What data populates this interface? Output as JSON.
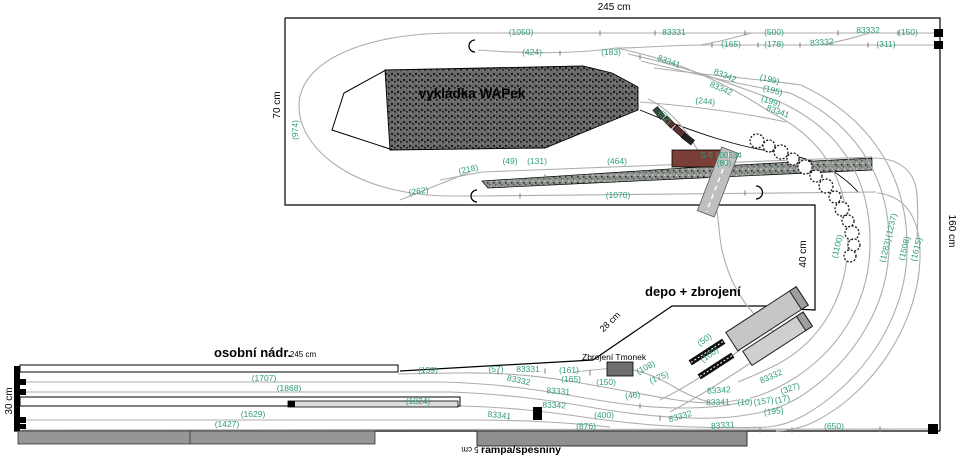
{
  "plan": {
    "areas": {
      "unloading_title": "vykládka WAPek",
      "depot_title": "depo + zbrojení",
      "station_title": "osobní nádr.",
      "ramp_label": "rampa/spesniny",
      "armory_label": "Zbrojení Tmonek"
    },
    "bridge": {
      "id": "S-5 100534",
      "length": "(80)"
    },
    "dim_labels": [
      {
        "t": "245 cm",
        "x": 614,
        "y": 10,
        "r": 0,
        "s": 10
      },
      {
        "t": "160 cm",
        "x": 949,
        "y": 231,
        "r": 90,
        "s": 10
      },
      {
        "t": "70 cm",
        "x": 280,
        "y": 105,
        "r": -90,
        "s": 10
      },
      {
        "t": "40 cm",
        "x": 806,
        "y": 254,
        "r": -90,
        "s": 10
      },
      {
        "t": "28 cm",
        "x": 612,
        "y": 324,
        "r": -44,
        "s": 9
      },
      {
        "t": "30 cm",
        "x": 12,
        "y": 401,
        "r": -90,
        "s": 10
      },
      {
        "t": "245 cm",
        "x": 303,
        "y": 357,
        "r": 0,
        "s": 8
      },
      {
        "t": "5 cm",
        "x": 470,
        "y": 447,
        "r": 180,
        "s": 8
      }
    ],
    "track_labels": [
      {
        "t": "(1050)",
        "x": 521,
        "y": 35,
        "r": 0
      },
      {
        "t": "83331",
        "x": 674,
        "y": 35,
        "r": 0
      },
      {
        "t": "(500)",
        "x": 774,
        "y": 35,
        "r": 0
      },
      {
        "t": "83332",
        "x": 868,
        "y": 33,
        "r": 0
      },
      {
        "t": "(150)",
        "x": 908,
        "y": 35,
        "r": 0
      },
      {
        "t": "(165)",
        "x": 731,
        "y": 47,
        "r": 0
      },
      {
        "t": "(178)",
        "x": 774,
        "y": 47,
        "r": 0
      },
      {
        "t": "83332",
        "x": 822,
        "y": 45,
        "r": -4
      },
      {
        "t": "(311)",
        "x": 886,
        "y": 47,
        "r": 0
      },
      {
        "t": "(424)",
        "x": 532,
        "y": 55,
        "r": 0
      },
      {
        "t": "(183)",
        "x": 611,
        "y": 55,
        "r": 0
      },
      {
        "t": "(974)",
        "x": 298,
        "y": 130,
        "r": -90
      },
      {
        "t": "83341",
        "x": 668,
        "y": 64,
        "r": 20
      },
      {
        "t": "83342",
        "x": 724,
        "y": 78,
        "r": 22
      },
      {
        "t": "83342",
        "x": 720,
        "y": 91,
        "r": 24
      },
      {
        "t": "(199)",
        "x": 769,
        "y": 82,
        "r": 14
      },
      {
        "t": "(195)",
        "x": 772,
        "y": 93,
        "r": 16
      },
      {
        "t": "(199)",
        "x": 770,
        "y": 104,
        "r": 18
      },
      {
        "t": "83341",
        "x": 777,
        "y": 114,
        "r": 20
      },
      {
        "t": "(244)",
        "x": 705,
        "y": 104,
        "r": 6
      },
      {
        "t": "(52)",
        "x": 663,
        "y": 119,
        "r": 48
      },
      {
        "t": "(218)",
        "x": 469,
        "y": 172,
        "r": -12
      },
      {
        "t": "(49)",
        "x": 510,
        "y": 164,
        "r": 0
      },
      {
        "t": "(131)",
        "x": 537,
        "y": 164,
        "r": 0
      },
      {
        "t": "(464)",
        "x": 617,
        "y": 164,
        "r": 0
      },
      {
        "t": "(262)",
        "x": 419,
        "y": 194,
        "r": -8
      },
      {
        "t": "(1070)",
        "x": 618,
        "y": 198,
        "r": 0
      },
      {
        "t": "(1100)",
        "x": 840,
        "y": 247,
        "r": -76
      },
      {
        "t": "(1237)",
        "x": 894,
        "y": 226,
        "r": -76
      },
      {
        "t": "(1283)",
        "x": 888,
        "y": 251,
        "r": -76
      },
      {
        "t": "(1508)",
        "x": 907,
        "y": 249,
        "r": -76
      },
      {
        "t": "(1615)",
        "x": 919,
        "y": 250,
        "r": -76
      },
      {
        "t": "(50)",
        "x": 706,
        "y": 342,
        "r": -35
      },
      {
        "t": "(100)",
        "x": 711,
        "y": 357,
        "r": -35
      },
      {
        "t": "(159)",
        "x": 428,
        "y": 373,
        "r": 0
      },
      {
        "t": "(57)",
        "x": 496,
        "y": 372,
        "r": 0
      },
      {
        "t": "83331",
        "x": 528,
        "y": 372,
        "r": 0
      },
      {
        "t": "(161)",
        "x": 569,
        "y": 373,
        "r": 0
      },
      {
        "t": "83332",
        "x": 518,
        "y": 383,
        "r": 12
      },
      {
        "t": "(165)",
        "x": 571,
        "y": 382,
        "r": 0
      },
      {
        "t": "(150)",
        "x": 606,
        "y": 385,
        "r": 0
      },
      {
        "t": "83331",
        "x": 558,
        "y": 394,
        "r": 4
      },
      {
        "t": "(46)",
        "x": 633,
        "y": 398,
        "r": -8
      },
      {
        "t": "83342",
        "x": 554,
        "y": 408,
        "r": 2
      },
      {
        "t": "83341",
        "x": 499,
        "y": 418,
        "r": 6
      },
      {
        "t": "(400)",
        "x": 604,
        "y": 418,
        "r": 0
      },
      {
        "t": "(876)",
        "x": 586,
        "y": 429,
        "r": 0
      },
      {
        "t": "(108)",
        "x": 647,
        "y": 370,
        "r": -28
      },
      {
        "t": "(175)",
        "x": 660,
        "y": 380,
        "r": -22
      },
      {
        "t": "83332",
        "x": 772,
        "y": 379,
        "r": -24
      },
      {
        "t": "83342",
        "x": 719,
        "y": 393,
        "r": -4
      },
      {
        "t": "(327)",
        "x": 791,
        "y": 391,
        "r": -20
      },
      {
        "t": "83341",
        "x": 718,
        "y": 405,
        "r": -2
      },
      {
        "t": "(10)",
        "x": 745,
        "y": 405,
        "r": 0
      },
      {
        "t": "(157)",
        "x": 764,
        "y": 404,
        "r": -8
      },
      {
        "t": "(17)",
        "x": 783,
        "y": 402,
        "r": -14
      },
      {
        "t": "(195)",
        "x": 774,
        "y": 414,
        "r": -6
      },
      {
        "t": "83332",
        "x": 681,
        "y": 419,
        "r": -16
      },
      {
        "t": "83331",
        "x": 723,
        "y": 428,
        "r": -4
      },
      {
        "t": "(650)",
        "x": 834,
        "y": 429,
        "r": 0
      },
      {
        "t": "(1707)",
        "x": 264,
        "y": 381,
        "r": 0
      },
      {
        "t": "(1868)",
        "x": 289,
        "y": 391,
        "r": 0
      },
      {
        "t": "(1824)",
        "x": 418,
        "y": 404,
        "r": 0
      },
      {
        "t": "(1629)",
        "x": 253,
        "y": 417,
        "r": 0
      },
      {
        "t": "(1427)",
        "x": 227,
        "y": 427,
        "r": 0
      }
    ]
  },
  "colors": {
    "label_green": "#2e9d72",
    "track_gray": "#adadad",
    "board_line": "#000000",
    "bridge": "#7a4038",
    "road": "#bfbfbf",
    "building": "#c6c6c6",
    "ramp_gray": "#969696",
    "armory_box": "#6f6f6f"
  }
}
